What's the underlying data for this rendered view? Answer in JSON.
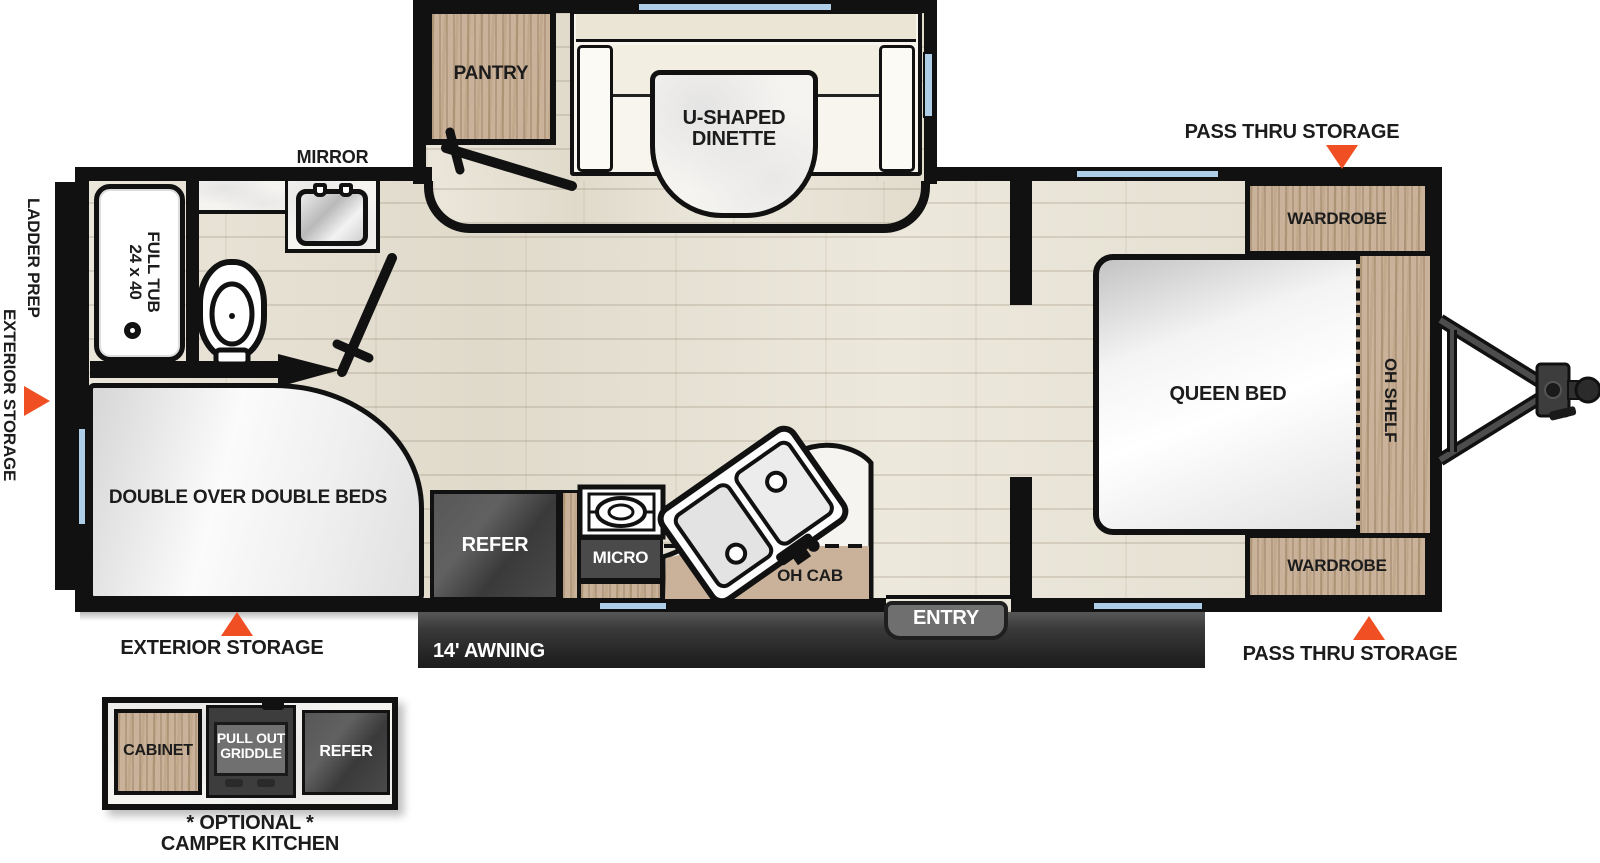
{
  "labels": {
    "pass_thru_storage": "PASS THRU STORAGE",
    "mirror": "MIRROR",
    "pantry": "PANTRY",
    "dinette_line1": "U-SHAPED",
    "dinette_line2": "DINETTE",
    "ladder_prep": "LADDER PREP",
    "exterior_storage": "EXTERIOR STORAGE",
    "tub_name": "FULL TUB",
    "tub_size": "24 x 40",
    "wardrobe": "WARDROBE",
    "oh_shelf": "OH SHELF",
    "queen_bed": "QUEEN BED",
    "double_beds": "DOUBLE OVER DOUBLE BEDS",
    "refer": "REFER",
    "micro": "MICRO",
    "oh_cab": "OH CAB",
    "entry": "ENTRY",
    "awning": "14' AWNING",
    "cabinet": "CABINET",
    "griddle_line1": "PULL OUT",
    "griddle_line2": "GRIDDLE",
    "optional": "* OPTIONAL *",
    "camper_kitchen": "CAMPER KITCHEN"
  },
  "colors": {
    "accent_orange": "#F04F23",
    "wall_black": "#111111",
    "cabinet_wood": "#C9B299",
    "floor": "#E8E3D6",
    "window_blue": "#AECDE6",
    "awning_dark": "#2F2F2F",
    "counter_marble": "#F5F4F1"
  }
}
